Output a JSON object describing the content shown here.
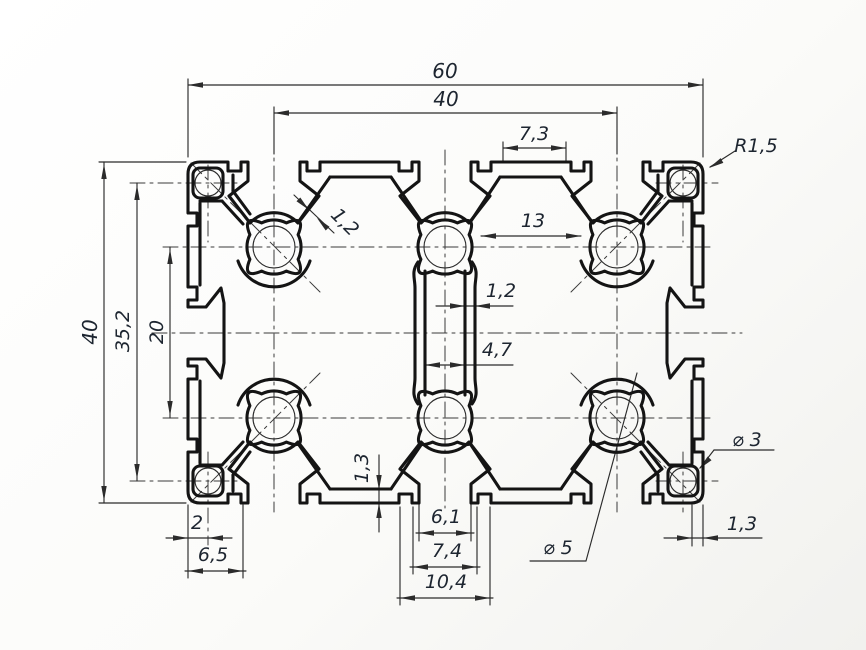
{
  "drawing": {
    "type": "technical-cross-section",
    "subject": "aluminium t-slot extrusion profile 40x60",
    "colors": {
      "outline": "#141414",
      "thin": "#2b2b2b",
      "centerline": "#3a3a3a",
      "text": "#1d2530",
      "background": "#fbfbf9"
    },
    "dimensions": {
      "total_width": "60",
      "slot_pitch_width": "40",
      "top_cavity_width": "7,3",
      "corner_radius": "R1,5",
      "boss_clearance": "13",
      "diagonal_wall_thickness": "1,2",
      "center_wall_thickness": "1,2",
      "channel_width": "4,7",
      "total_height": "40",
      "corner_hole_pitch": "35,2",
      "slot_pitch_height": "20",
      "bottom_wall_thickness": "1,3",
      "edge_to_corner_hole": "2",
      "corner_ear_width": "6,5",
      "slot_opening": "6,1",
      "slot_lip_width": "7,4",
      "slot_recess_width": "10,4",
      "core_hole_diameter": "⌀ 5",
      "corner_hole_diameter": "⌀ 3",
      "right_edge_wall": "1,3"
    }
  }
}
